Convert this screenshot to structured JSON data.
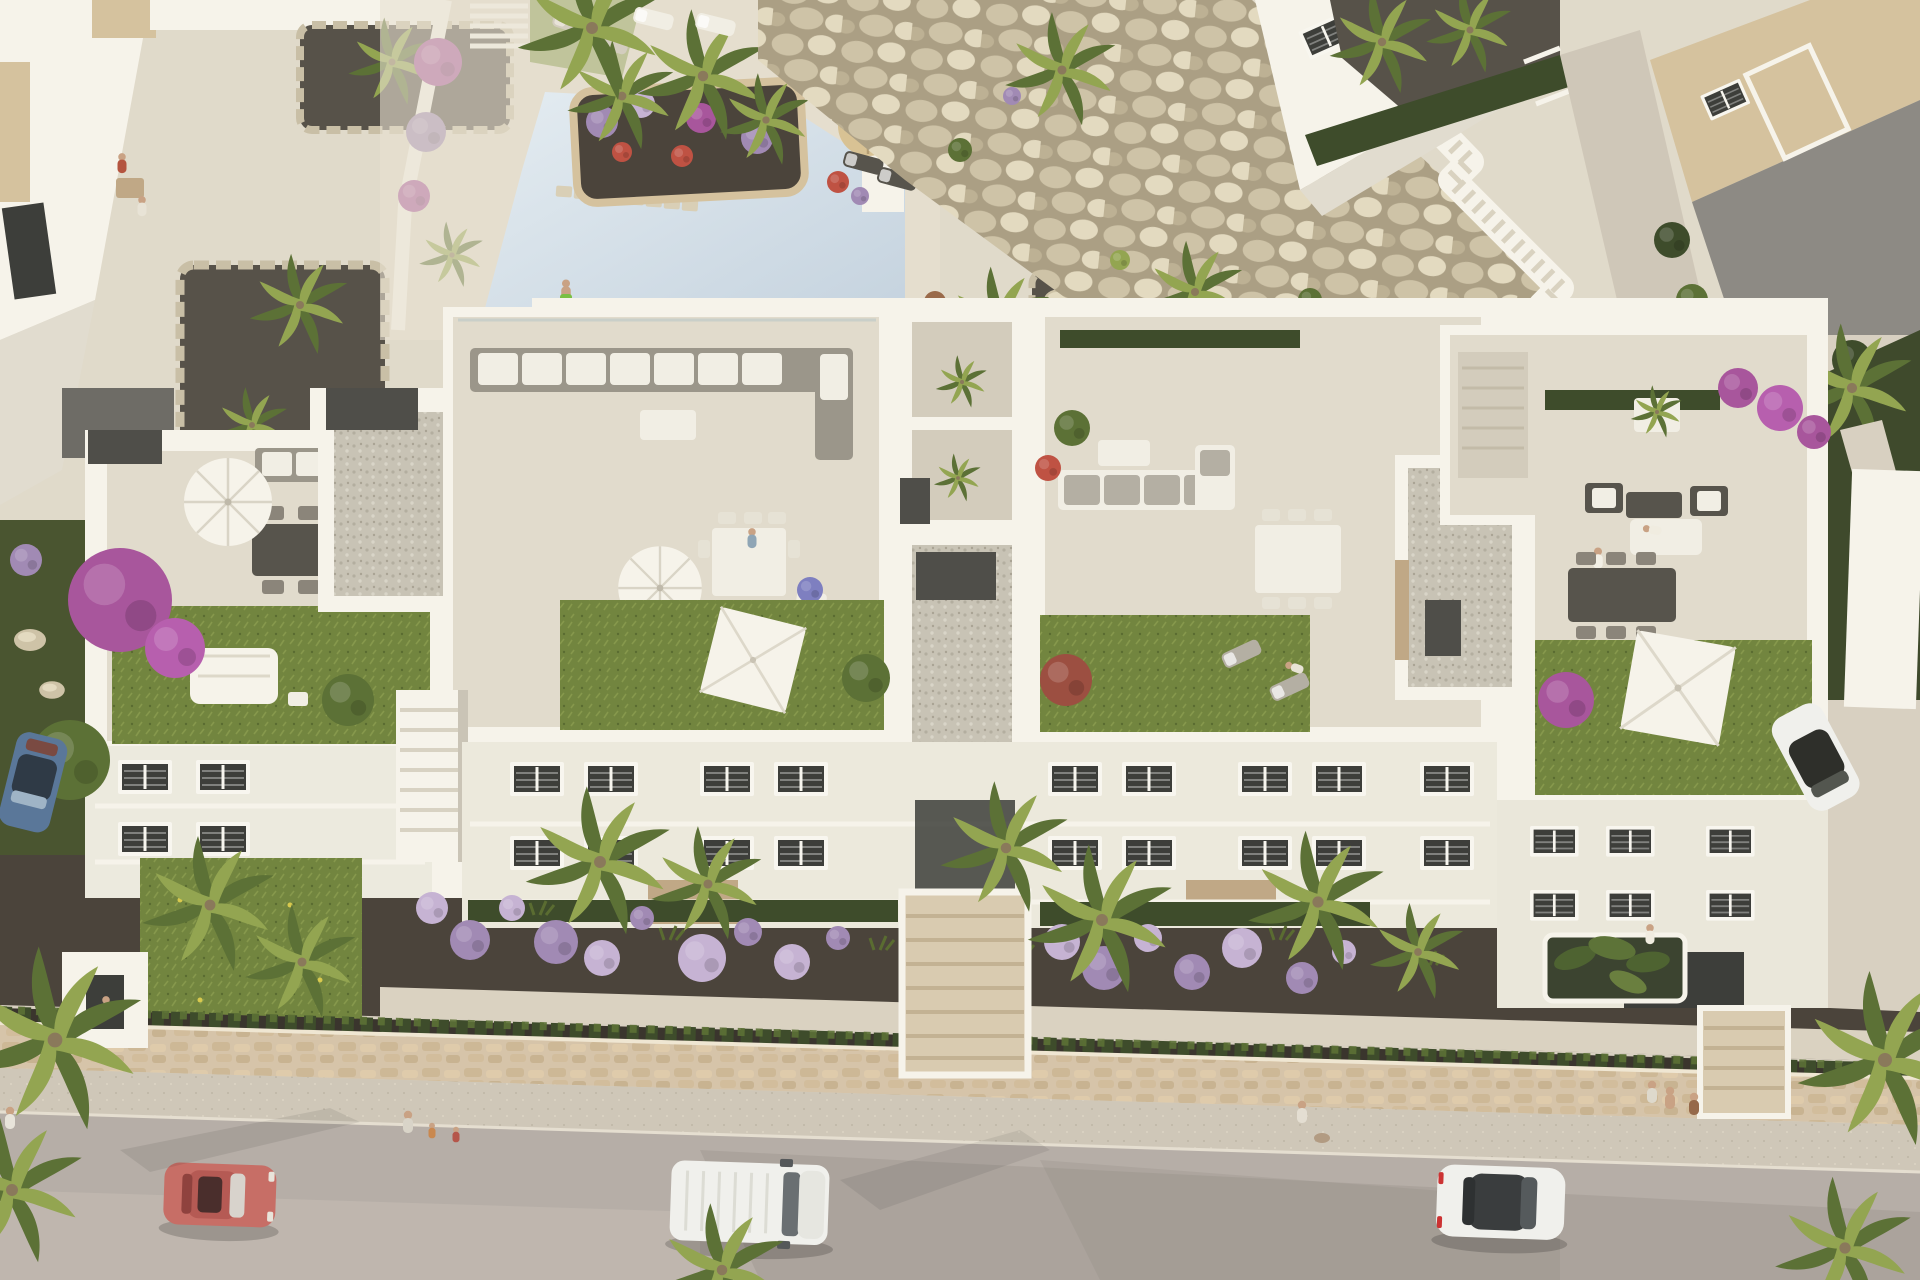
{
  "scene": {
    "alt": "Aerial 3D architectural rendering of a white Mediterranean apartment complex with rooftop terraces, a communal swimming pool, boulder embankment, front gardens, and a street with passing cars and pedestrians",
    "elements": [
      "communal swimming pool with stepping stones and flower island",
      "boulder rock embankment with white staircase ramp",
      "four rooftop terraces with parasols, sofas, dining sets, lawns and gravel roofs",
      "three-storey white facades with shuttered windows and balconies",
      "front gardens with purple ball shrubs and palm trees",
      "stone perimeter wall, hedge row, sidewalk",
      "street with red coupe, white van, white sedan",
      "parked blue car and parked white car",
      "pedestrians and sunbathers"
    ]
  },
  "palette": {
    "deck": "#d8d0c1",
    "deckLight": "#e8e1d1",
    "road": "#b6aea7",
    "roadLight": "#c9c1b8",
    "roadShadow": "#8e8780",
    "sidewalk": "#cfc7b8",
    "walkway": "#dad2c1",
    "wall": "#d6c4a9",
    "wallHi": "#efe6d2",
    "mulch": "#4b443b",
    "gravelDark": "#575249",
    "white": "#f6f3ea",
    "whiteShade": "#e1dccf",
    "whiteDark": "#cac4b6",
    "tile": "#e1dbcc",
    "tileShade": "#d3ccbc",
    "gravel": "#c8c3b5",
    "lawn": "#72853f",
    "lawnLight": "#86984c",
    "lawnDark": "#5a6c31",
    "hedge": "#3e4c2b",
    "leaf": "#5c7136",
    "leafLight": "#93a551",
    "boulder": "#cec3a7",
    "boulderHi": "#e3dac0",
    "boulderLo": "#ab9f84",
    "pool": "#c4d2de",
    "poolLight": "#e4ecf1",
    "purple": "#a18ab4",
    "purpleLight": "#c6b3d3",
    "magenta": "#a8569c",
    "redFlower": "#bf5243",
    "furnDark": "#57544c",
    "furnWhite": "#f1eee4",
    "cushGray": "#b4afa3",
    "wood": "#c0a886",
    "stoneBeige": "#d5c29e",
    "glass": "#3d3e3a",
    "frame": "#f8f6ef",
    "carRed": "#c76e66",
    "carBlue": "#5a7799",
    "carWhite": "#f0f0ec",
    "skin": "#c9a284",
    "strawTan": "#d8c294"
  }
}
